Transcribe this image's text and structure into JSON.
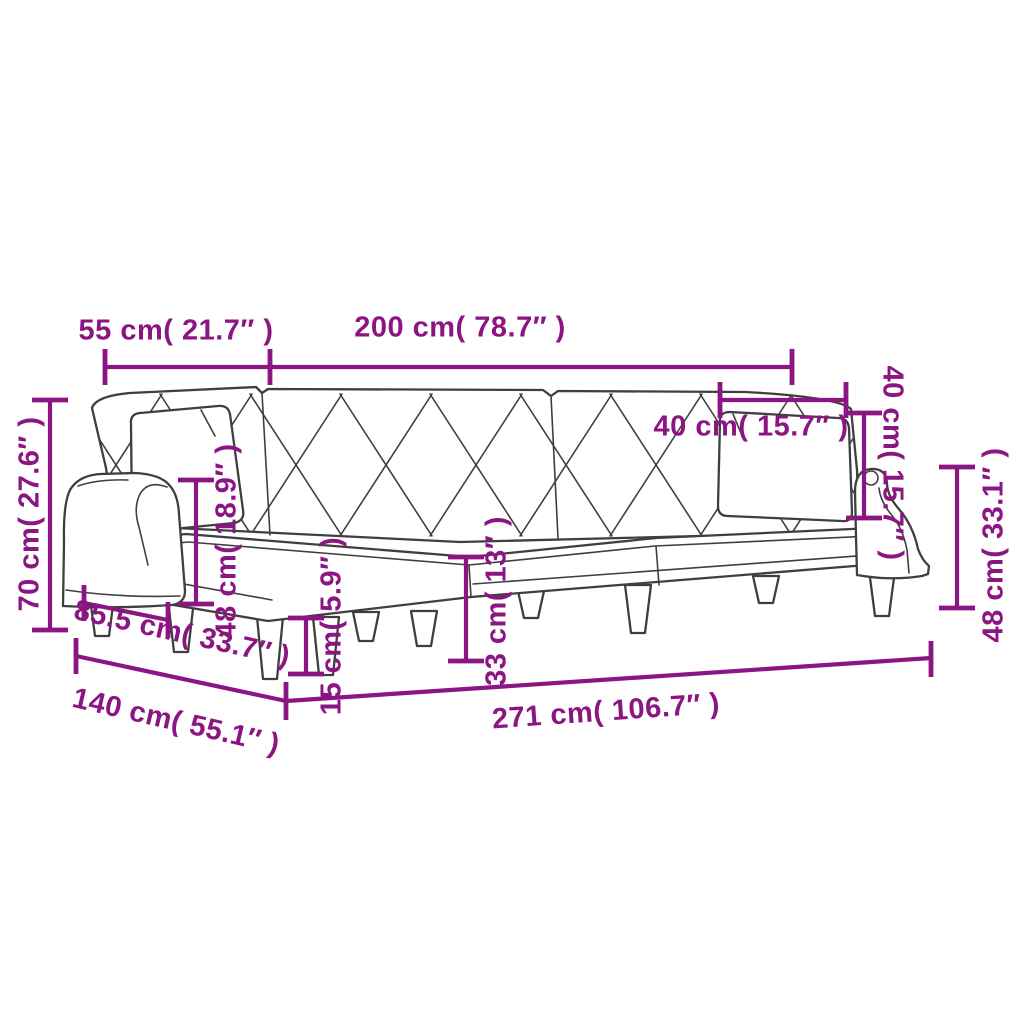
{
  "diagram": {
    "subject": "l-shaped-sofa-bed-dimension-diagram",
    "accent_color": "#8b1583",
    "outline_color": "#3f3f3f",
    "background_color": "#ffffff"
  },
  "dimensions": {
    "top_width_left": {
      "label": "55 cm( 21.7″ )",
      "value_cm": 55,
      "value_in": 21.7
    },
    "top_width_main": {
      "label": "200 cm( 78.7″ )",
      "value_cm": 200,
      "value_in": 78.7
    },
    "overall_height": {
      "label": "70 cm( 27.6″ )",
      "value_cm": 70,
      "value_in": 27.6
    },
    "seat_height_left": {
      "label": "48 cm( 18.9″ )",
      "value_cm": 48,
      "value_in": 18.9
    },
    "leg_height": {
      "label": "15 cm( 5.9″ )",
      "value_cm": 15,
      "value_in": 5.9
    },
    "seat_height_front": {
      "label": "33 cm( 13″ )",
      "value_cm": 33,
      "value_in": 13
    },
    "pillow_width": {
      "label": "40 cm( 15.7″ )",
      "value_cm": 40,
      "value_in": 15.7
    },
    "pillow_height": {
      "label": "40 cm( 15.7″ )",
      "value_cm": 40,
      "value_in": 15.7
    },
    "backrest_height": {
      "label": "48 cm( 33.1″ )",
      "value_cm": 48,
      "value_in": 33.1
    },
    "depth_left": {
      "label": "85.5 cm( 33.7″ )",
      "value_cm": 85.5,
      "value_in": 33.7
    },
    "depth_total": {
      "label": "140 cm( 55.1″ )",
      "value_cm": 140,
      "value_in": 55.1
    },
    "total_width": {
      "label": "271 cm( 106.7″ )",
      "value_cm": 271,
      "value_in": 106.7
    }
  }
}
